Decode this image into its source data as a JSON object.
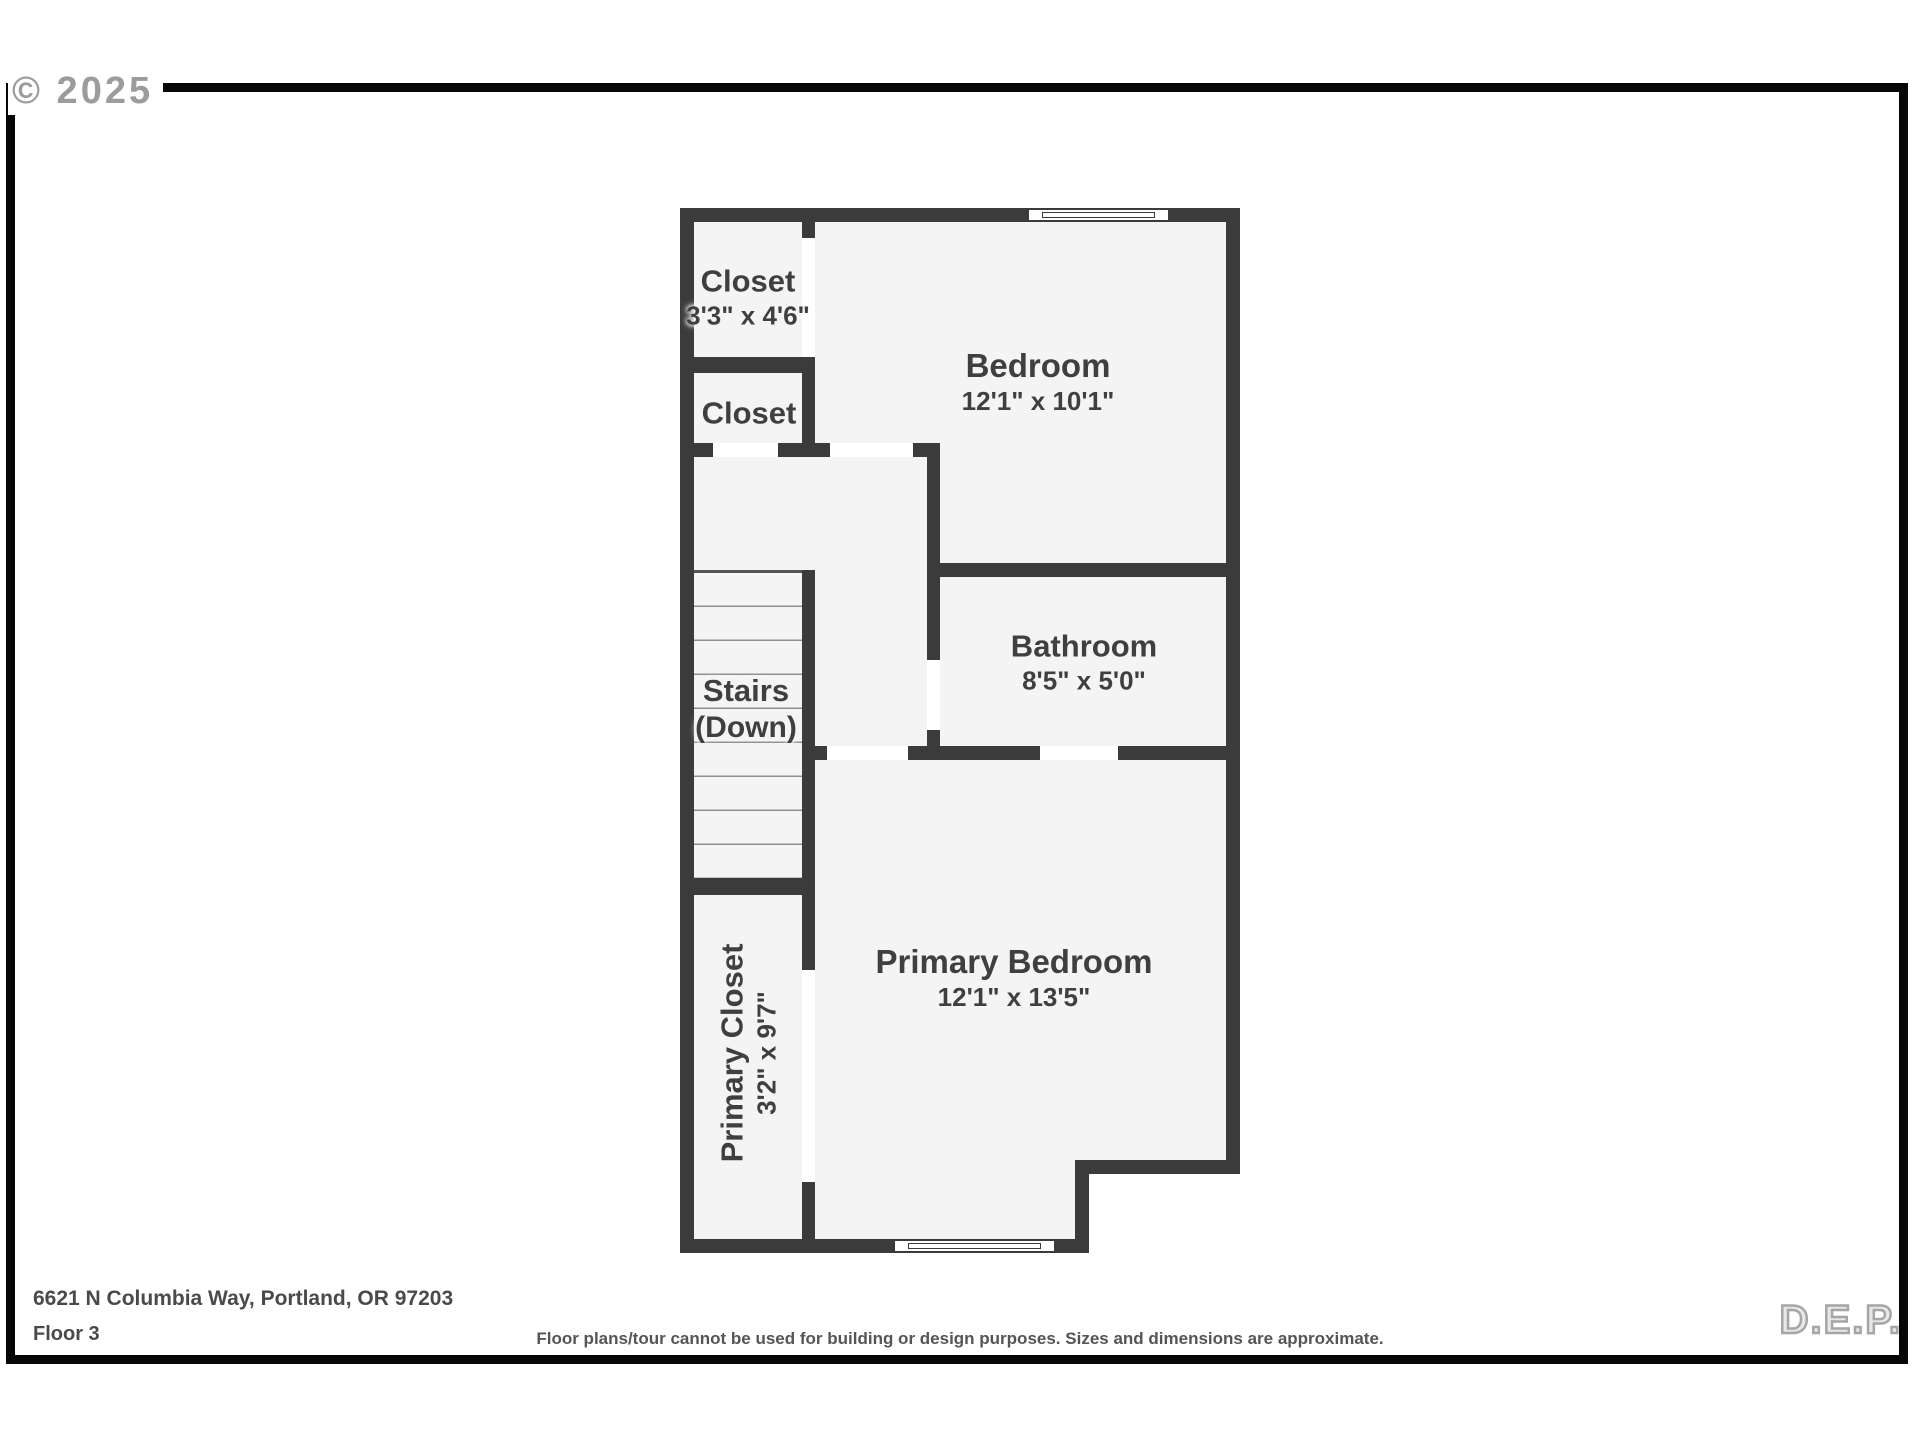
{
  "watermarks": {
    "top_left": "© 2025",
    "bottom_right": "D.E.P."
  },
  "footer": {
    "address": "6621 N Columbia Way, Portland, OR 97203",
    "floor_label": "Floor 3",
    "disclaimer": "Floor plans/tour cannot be used for building or design purposes. Sizes and dimensions are approximate."
  },
  "colors": {
    "wall": "#3b3b3b",
    "floor_fill": "#f4f4f4",
    "door_opening": "#ffffff",
    "label_text": "#3f3f3f",
    "watermark_gray": "#9c9c9c"
  },
  "rooms": {
    "closet_top": {
      "name": "Closet",
      "dims": "3'3\" x 4'6\""
    },
    "closet_mid": {
      "name": "Closet"
    },
    "bedroom": {
      "name": "Bedroom",
      "dims": "12'1\" x 10'1\""
    },
    "bathroom": {
      "name": "Bathroom",
      "dims": "8'5\" x 5'0\""
    },
    "stairs": {
      "name": "Stairs",
      "sub": "(Down)"
    },
    "primary_closet": {
      "name": "Primary Closet",
      "dims": "3'2\" x 9'7\""
    },
    "primary_bedroom": {
      "name": "Primary Bedroom",
      "dims": "12'1\" x 13'5\""
    }
  }
}
